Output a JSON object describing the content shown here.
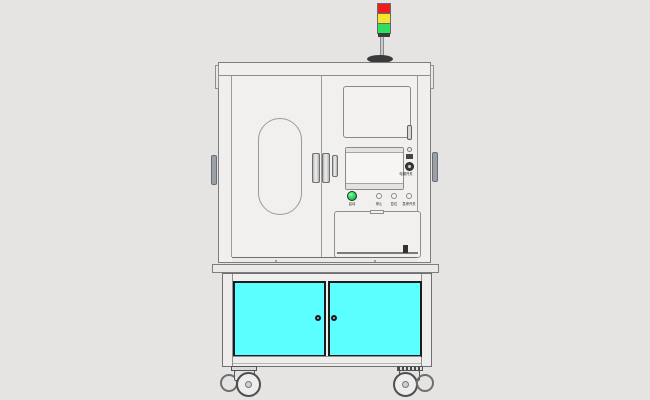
{
  "scene": {
    "description": "CAD front-view rendering of an industrial automated test equipment cabinet on casters",
    "sections": [
      "signal-tower",
      "upper-enclosure",
      "control-panel",
      "lower-storage-cabinet",
      "casters"
    ]
  },
  "colors": {
    "bg": "#e6e4e2",
    "body": "#f1f0ee",
    "line": "#8f8f8f",
    "cyan": "#5cffff",
    "door-border": "#1c1c1c",
    "red": "#ee1c1c",
    "yellow": "#f2e52c",
    "green": "#2fe05e",
    "btn-green": "#1ed24f",
    "metal": "#c9c9c9",
    "handle": "#9aa0a6"
  },
  "tower": {
    "segments": [
      {
        "name": "red-lamp",
        "color": "#ee1c1c"
      },
      {
        "name": "yellow-lamp",
        "color": "#f2e52c"
      },
      {
        "name": "green-lamp",
        "color": "#2fe05e"
      }
    ]
  },
  "control_panel": {
    "side_controls": {
      "indicator": "indicator-lamp",
      "port": "usb-port",
      "knob": "key-switch-knob",
      "label": "电源开关"
    },
    "buttons": [
      {
        "label": "启动",
        "color": "#1ed24f"
      },
      {
        "label": "停止",
        "color": "#f3f3f3"
      },
      {
        "label": "复位",
        "color": "#f3f3f3"
      },
      {
        "label": "急停开关",
        "color": "#f3f3f3"
      }
    ]
  },
  "lower_cabinet": {
    "doors": [
      {
        "name": "left-storage-door",
        "color": "#5cffff"
      },
      {
        "name": "right-storage-door",
        "color": "#5cffff"
      }
    ]
  }
}
